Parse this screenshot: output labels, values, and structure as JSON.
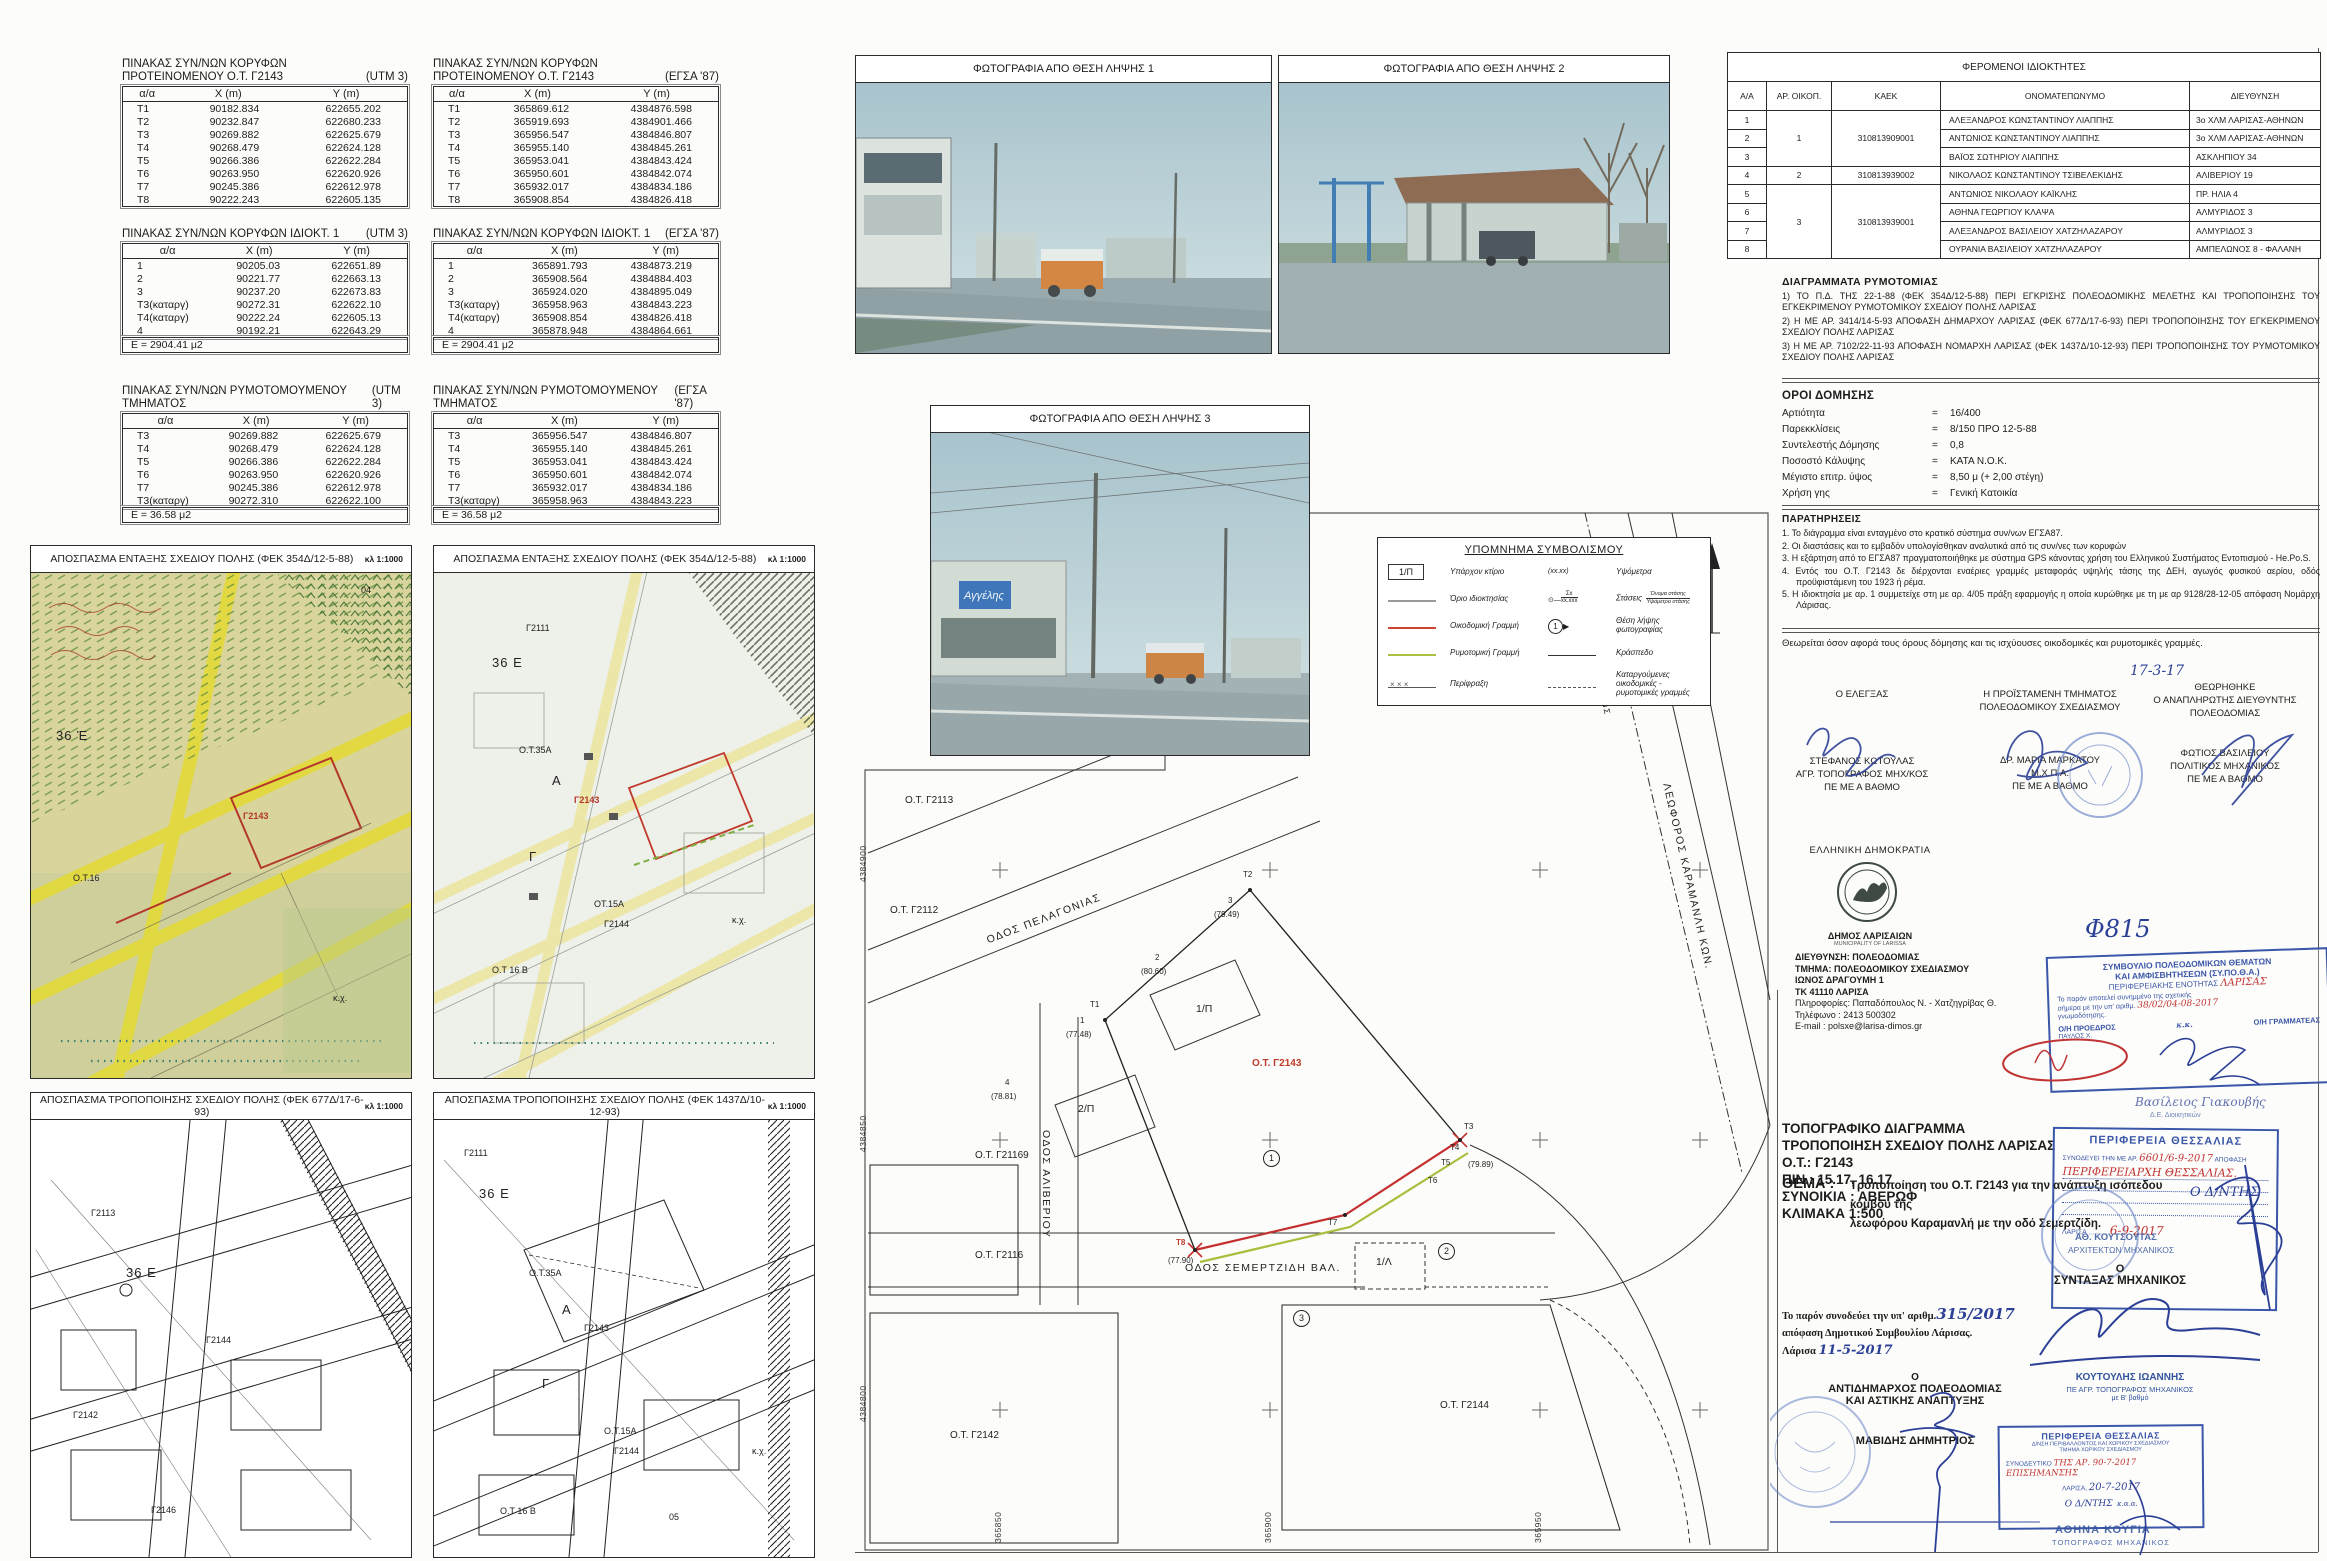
{
  "tables": {
    "cols": [
      "α/α",
      "X (m)",
      "Y (m)"
    ],
    "a": {
      "title1": "ΠΙΝΑΚΑΣ ΣΥΝ/ΝΩΝ ΚΟΡΥΦΩΝ",
      "title2": "ΠΡΟΤΕΙΝΟΜΕΝΟΥ Ο.Τ. Γ2143",
      "system": "(UTM 3)",
      "rows": [
        [
          "Τ1",
          "90182.834",
          "622655.202"
        ],
        [
          "Τ2",
          "90232.847",
          "622680.233"
        ],
        [
          "Τ3",
          "90269.882",
          "622625.679"
        ],
        [
          "Τ4",
          "90268.479",
          "622624.128"
        ],
        [
          "Τ5",
          "90266.386",
          "622622.284"
        ],
        [
          "Τ6",
          "90263.950",
          "622620.926"
        ],
        [
          "Τ7",
          "90245.386",
          "622612.978"
        ],
        [
          "Τ8",
          "90222.243",
          "622605.135"
        ]
      ]
    },
    "b": {
      "title1": "ΠΙΝΑΚΑΣ ΣΥΝ/ΝΩΝ ΚΟΡΥΦΩΝ",
      "title2": "ΠΡΟΤΕΙΝΟΜΕΝΟΥ Ο.Τ. Γ2143",
      "system": "(ΕΓΣΑ '87)",
      "rows": [
        [
          "Τ1",
          "365869.612",
          "4384876.598"
        ],
        [
          "Τ2",
          "365919.693",
          "4384901.466"
        ],
        [
          "Τ3",
          "365956.547",
          "4384846.807"
        ],
        [
          "Τ4",
          "365955.140",
          "4384845.261"
        ],
        [
          "Τ5",
          "365953.041",
          "4384843.424"
        ],
        [
          "Τ6",
          "365950.601",
          "4384842.074"
        ],
        [
          "Τ7",
          "365932.017",
          "4384834.186"
        ],
        [
          "Τ8",
          "365908.854",
          "4384826.418"
        ]
      ]
    },
    "c": {
      "title1": "ΠΙΝΑΚΑΣ ΣΥΝ/ΝΩΝ ΚΟΡΥΦΩΝ ΙΔΙΟΚΤ. 1",
      "title2": "",
      "system": "(UTM 3)",
      "footer": "Ε = 2904.41 μ2",
      "rows": [
        [
          "1",
          "90205.03",
          "622651.89"
        ],
        [
          "2",
          "90221.77",
          "622663.13"
        ],
        [
          "3",
          "90237.20",
          "622673.83"
        ],
        [
          "Τ3(καταργ)",
          "90272.31",
          "622622.10"
        ],
        [
          "Τ4(καταργ)",
          "90222.24",
          "622605.13"
        ],
        [
          "4",
          "90192.21",
          "622643.29"
        ]
      ]
    },
    "d": {
      "title1": "ΠΙΝΑΚΑΣ ΣΥΝ/ΝΩΝ ΚΟΡΥΦΩΝ ΙΔΙΟΚΤ. 1",
      "title2": "",
      "system": "(ΕΓΣΑ '87)",
      "footer": "Ε = 2904.41 μ2",
      "rows": [
        [
          "1",
          "365891.793",
          "4384873.219"
        ],
        [
          "2",
          "365908.564",
          "4384884.403"
        ],
        [
          "3",
          "365924.020",
          "4384895.049"
        ],
        [
          "Τ3(καταργ)",
          "365958.963",
          "4384843.223"
        ],
        [
          "Τ4(καταργ)",
          "365908.854",
          "4384826.418"
        ],
        [
          "4",
          "365878.948",
          "4384864.661"
        ]
      ]
    },
    "e": {
      "title1": "ΠΙΝΑΚΑΣ ΣΥΝ/ΝΩΝ ΡΥΜΟΤΟΜΟΥΜΕΝΟΥ ΤΜΗΜΑΤΟΣ",
      "title2": "",
      "system": "(UTM 3)",
      "footer": "Ε = 36.58 μ2",
      "rows": [
        [
          "Τ3",
          "90269.882",
          "622625.679"
        ],
        [
          "Τ4",
          "90268.479",
          "622624.128"
        ],
        [
          "Τ5",
          "90266.386",
          "622622.284"
        ],
        [
          "Τ6",
          "90263.950",
          "622620.926"
        ],
        [
          "Τ7",
          "90245.386",
          "622612.978"
        ],
        [
          "Τ3(καταργ)",
          "90272.310",
          "622622.100"
        ]
      ]
    },
    "f": {
      "title1": "ΠΙΝΑΚΑΣ ΣΥΝ/ΝΩΝ ΡΥΜΟΤΟΜΟΥΜΕΝΟΥ ΤΜΗΜΑΤΟΣ",
      "title2": "",
      "system": "(ΕΓΣΑ '87)",
      "footer": "Ε = 36.58 μ2",
      "rows": [
        [
          "Τ3",
          "365956.547",
          "4384846.807"
        ],
        [
          "Τ4",
          "365955.140",
          "4384845.261"
        ],
        [
          "Τ5",
          "365953.041",
          "4384843.424"
        ],
        [
          "Τ6",
          "365950.601",
          "4384842.074"
        ],
        [
          "Τ7",
          "365932.017",
          "4384834.186"
        ],
        [
          "Τ3(καταργ)",
          "365958.963",
          "4384843.223"
        ]
      ]
    }
  },
  "photos": [
    {
      "title": "ΦΩΤΟΓΡΑΦΙΑ ΑΠΟ ΘΕΣΗ ΛΗΨΗΣ 1"
    },
    {
      "title": "ΦΩΤΟΓΡΑΦΙΑ ΑΠΟ ΘΕΣΗ ΛΗΨΗΣ 2"
    },
    {
      "title": "ΦΩΤΟΓΡΑΦΙΑ ΑΠΟ ΘΕΣΗ ΛΗΨΗΣ 3",
      "sign": "Αγγέλης"
    }
  ],
  "excerpts": [
    {
      "title": "ΑΠΟΣΠΑΣΜΑ ΕΝΤΑΞΗΣ ΣΧΕΔΙΟΥ ΠΟΛΗΣ (ΦΕΚ 354Δ/12-5-88)",
      "scale": "κλ 1:1000",
      "labels": [
        {
          "t": "04",
          "x": 330,
          "y": 12
        },
        {
          "t": "36 Έ",
          "x": 25,
          "y": 155,
          "cls": "big"
        },
        {
          "t": "Γ2143",
          "x": 212,
          "y": 238,
          "cls": "red"
        },
        {
          "t": "Ο.Τ.16",
          "x": 42,
          "y": 300
        },
        {
          "t": "κ.χ.",
          "x": 302,
          "y": 420
        }
      ]
    },
    {
      "title": "ΑΠΟΣΠΑΣΜΑ ΕΝΤΑΞΗΣ ΣΧΕΔΙΟΥ ΠΟΛΗΣ (ΦΕΚ 354Δ/12-5-88)",
      "scale": "κλ 1:1000",
      "labels": [
        {
          "t": "Γ2111",
          "x": 92,
          "y": 50
        },
        {
          "t": "36 Ε",
          "x": 58,
          "y": 82,
          "cls": "big"
        },
        {
          "t": "Ο.Τ.35Α",
          "x": 85,
          "y": 172
        },
        {
          "t": "Α",
          "x": 118,
          "y": 200,
          "cls": "big"
        },
        {
          "t": "Γ2143",
          "x": 140,
          "y": 222,
          "cls": "red"
        },
        {
          "t": "Γ",
          "x": 95,
          "y": 276,
          "cls": "big"
        },
        {
          "t": "ΟΤ.15Α",
          "x": 160,
          "y": 326
        },
        {
          "t": "Γ2144",
          "x": 170,
          "y": 346
        },
        {
          "t": "Ο.Τ 16 Β",
          "x": 58,
          "y": 392
        },
        {
          "t": "κ.χ.",
          "x": 298,
          "y": 342
        }
      ]
    },
    {
      "title": "ΑΠΟΣΠΑΣΜΑ ΤΡΟΠΟΠΟΙΗΣΗΣ ΣΧΕΔΙΟΥ ΠΟΛΗΣ (ΦΕΚ 677Δ/17-6-93)",
      "scale": "κλ 1:1000",
      "labels": [
        {
          "t": "Γ2113",
          "x": 60,
          "y": 88
        },
        {
          "t": "36 Ε",
          "x": 95,
          "y": 145,
          "cls": "big"
        },
        {
          "t": "Γ2144",
          "x": 175,
          "y": 215
        },
        {
          "t": "Γ2142",
          "x": 42,
          "y": 290
        },
        {
          "t": "Γ2146",
          "x": 120,
          "y": 385
        }
      ]
    },
    {
      "title": "ΑΠΟΣΠΑΣΜΑ ΤΡΟΠΟΠΟΙΗΣΗΣ ΣΧΕΔΙΟΥ ΠΟΛΗΣ (ΦΕΚ 1437Δ/10-12-93)",
      "scale": "κλ 1:1000",
      "labels": [
        {
          "t": "Γ2111",
          "x": 30,
          "y": 28
        },
        {
          "t": "36 Ε",
          "x": 45,
          "y": 66,
          "cls": "big"
        },
        {
          "t": "Ο.Τ.35Α",
          "x": 95,
          "y": 148
        },
        {
          "t": "Α",
          "x": 128,
          "y": 182,
          "cls": "big"
        },
        {
          "t": "Γ2143",
          "x": 150,
          "y": 203
        },
        {
          "t": "Γ",
          "x": 108,
          "y": 256,
          "cls": "big"
        },
        {
          "t": "Ο.Τ.15Α",
          "x": 170,
          "y": 306
        },
        {
          "t": "Γ2144",
          "x": 180,
          "y": 326
        },
        {
          "t": "Ο.Τ 16 Β",
          "x": 66,
          "y": 386
        },
        {
          "t": "05",
          "x": 235,
          "y": 392
        },
        {
          "t": "κ.χ.",
          "x": 318,
          "y": 326
        }
      ]
    }
  ],
  "legend": {
    "title": "ΥΠΟΜΝΗΜΑ ΣΥΜΒΟΛΙΣΜΟΥ",
    "box_label": "1/Π",
    "left": [
      {
        "label": "Υπάρχον κτίριο"
      },
      {
        "label": "Όριο ιδιοκτησίας"
      },
      {
        "label": "Οικοδομική Γραμμή"
      },
      {
        "label": "Ρυμοτομική Γραμμή"
      },
      {
        "label": "Περίφραξη"
      }
    ],
    "right": [
      {
        "label": "Υψόμετρα",
        "sym": "(xx.xx)"
      },
      {
        "label": "Στάσεις",
        "sym_top": "Σx",
        "sym_bot": "xx.xxx",
        "name": "Όνομα στάσης",
        "elev": "Υψόμετρο στάσης"
      },
      {
        "label": "Θέση λήψης φωτογραφίας",
        "num": "1"
      },
      {
        "label": "Κράσπεδο"
      },
      {
        "label": "Καταργούμενες οικοδομικές - ρυμοτομικές γραμμές"
      }
    ]
  },
  "owners": {
    "title": "ΦΕΡΟΜΕΝΟΙ ΙΔΙΟΚΤΗΤΕΣ",
    "cols": [
      "Α/Α",
      "ΑΡ. ΟΙΚΟΠ.",
      "ΚΑΕΚ",
      "ΟΝΟΜΑΤΕΠΩΝΥΜΟ",
      "ΔΙΕΥΘΥΝΣΗ"
    ],
    "groups": [
      {
        "oikop": "1",
        "kaek": "310813909001"
      },
      {
        "oikop": "2",
        "kaek": "310813939002"
      },
      {
        "oikop": "3",
        "kaek": "310813939001"
      }
    ],
    "rows": [
      {
        "aa": "1",
        "name": "ΑΛΕΞΑΝΔΡΟΣ ΚΩΝΣΤΑΝΤΙΝΟΥ ΛΙΑΠΠΗΣ",
        "addr": "3ο ΧΛΜ ΛΑΡΙΣΑΣ-ΑΘΗΝΩΝ"
      },
      {
        "aa": "2",
        "name": "ΑΝΤΩΝΙΟΣ ΚΩΝΣΤΑΝΤΙΝΟΥ ΛΙΑΠΠΗΣ",
        "addr": "3ο ΧΛΜ ΛΑΡΙΣΑΣ-ΑΘΗΝΩΝ"
      },
      {
        "aa": "3",
        "name": "ΒΑΪΟΣ ΣΩΤΗΡΙΟΥ ΛΙΑΠΠΗΣ",
        "addr": "ΑΣΚΛΗΠΙΟΥ 34"
      },
      {
        "aa": "4",
        "name": "ΝΙΚΟΛΑΟΣ ΚΩΝΣΤΑΝΤΙΝΟΥ ΤΣΙΒΕΛΕΚΙΔΗΣ",
        "addr": "ΑΛΙΒΕΡΙΟΥ 19"
      },
      {
        "aa": "5",
        "name": "ΑΝΤΩΝΙΟΣ ΝΙΚΟΛΑΟΥ ΚΑΪΚΛΗΣ",
        "addr": "ΠΡ. ΗΛΙΑ 4"
      },
      {
        "aa": "6",
        "name": "ΑΘΗΝΑ ΓΕΩΡΓΙΟΥ ΚΛΑΨΑ",
        "addr": "ΑΛΜΥΡΙΔΟΣ 3"
      },
      {
        "aa": "7",
        "name": "ΑΛΕΞΑΝΔΡΟΣ ΒΑΣΙΛΕΙΟΥ ΧΑΤΖΗΛΑΖΑΡΟΥ",
        "addr": "ΑΛΜΥΡΙΔΟΣ 3"
      },
      {
        "aa": "8",
        "name": "ΟΥΡΑΝΙΑ ΒΑΣΙΛΕΙΟΥ ΧΑΤΖΗΛΑΖΑΡΟΥ",
        "addr": "ΑΜΠΕΛΩΝΟΣ 8 - ΦΑΛΑΝΗ"
      }
    ]
  },
  "diagrams": {
    "title": "ΔΙΑΓΡΑΜΜΑΤΑ ΡΥΜΟΤΟΜΙΑΣ",
    "items": [
      "1) ΤΟ Π.Δ. ΤΗΣ 22-1-88 (ΦΕΚ 354Δ/12-5-88) ΠΕΡΙ ΕΓΚΡΙΣΗΣ ΠΟΛΕΟΔΟΜΙΚΗΣ ΜΕΛΕΤΗΣ ΚΑΙ ΤΡΟΠΟΠΟΙΗΣΗΣ ΤΟΥ ΕΓΚΕΚΡΙΜΕΝΟΥ ΡΥΜΟΤΟΜΙΚΟΥ ΣΧΕΔΙΟΥ ΠΟΛΗΣ ΛΑΡΙΣΑΣ",
      "2) Η ΜΕ ΑΡ. 3414/14-5-93 ΑΠΟΦΑΣΗ ΔΗΜΑΡΧΟΥ ΛΑΡΙΣΑΣ (ΦΕΚ 677Δ/17-6-93) ΠΕΡΙ ΤΡΟΠΟΠΟΙΗΣΗΣ ΤΟΥ ΕΓΚΕΚΡΙΜΕΝΟΥ ΣΧΕΔΙΟΥ ΠΟΛΗΣ ΛΑΡΙΣΑΣ",
      "3) Η ΜΕ ΑΡ. 7102/22-11-93 ΑΠΟΦΑΣΗ ΝΟΜΑΡΧΗ ΛΑΡΙΣΑΣ (ΦΕΚ 1437Δ/10-12-93) ΠΕΡΙ ΤΡΟΠΟΠΟΙΗΣΗΣ ΤΟΥ ΡΥΜΟΤΟΜΙΚΟΥ ΣΧΕΔΙΟΥ ΠΟΛΗΣ  ΛΑΡΙΣΑΣ"
    ]
  },
  "terms": {
    "title": "ΟΡΟΙ ΔΟΜΗΣΗΣ",
    "eq": "=",
    "rows": [
      [
        "Αρτιότητα",
        "16/400"
      ],
      [
        "Παρεκκλίσεις",
        "8/150 ΠΡΟ 12-5-88"
      ],
      [
        "Συντελεστής Δόμησης",
        "0,8"
      ],
      [
        "Ποσοστό Κάλυψης",
        "ΚΑΤΑ Ν.Ο.Κ."
      ],
      [
        "Μέγιστο επιτρ. ύψος",
        "8,50 μ (+ 2,00 στέγη)"
      ],
      [
        "Χρήση γης",
        "Γενική Κατοικία"
      ]
    ]
  },
  "notes": {
    "title": "ΠΑΡΑΤΗΡΗΣΕΙΣ",
    "items": [
      "1.   Το διάγραμμα είναι ενταγμένο στο κρατικό σύστημα συν/νων ΕΓΣΑ87.",
      "2.   Οι διαστάσεις και το εμβαδόν υπολογίσθηκαν αναλυτικά από τις συν/νες των κορυφών",
      "3.   Η εξάρτηση από το ΕΓΣΑ87 πραγματοποιήθηκε με σύστημα GPS κάνοντας χρήση του Ελληνικού Συστήματος Εντοπισμού - He.Po.S.",
      "4.   Εντός του  Ο.Τ. Γ2143 δε διέρχονται εναέριες γραμμές μεταφοράς υψηλής τάσης της ΔΕΗ, αγωγός φυσικού αερίου, οδός προϋφιστάμενη του 1923 ή ρέμα.",
      "5.   Η ιδιοκτησία με αρ. 1 συμμετείχε στη με αρ. 4/05 πράξη εφαρμογής η οποία κυρώθηκε με τη με αρ 9128/28-12-05 απόφαση Νομάρχη Λάρισας."
    ]
  },
  "approval": "Θεωρείται όσον αφορά τους όρους δόμησης και τις ισχύουσες οικοδομικές και ρυμοτομικές γραμμές.",
  "signs": {
    "date": "17-3-17",
    "c1": {
      "role": "Ο ΕΛΕΓΞΑΣ",
      "name": "ΣΤΕΦΑΝΟΣ ΚΩΤΟΥΛΑΣ",
      "title": "ΑΓΡ. ΤΟΠΟΓΡΑΦΟΣ ΜΗΧ/ΚΟΣ",
      "grade": "ΠΕ ΜΕ Α ΒΑΘΜΟ"
    },
    "c2": {
      "role1": "Η ΠΡΟΪΣΤΑΜΕΝΗ ΤΜΗΜΑΤΟΣ",
      "role2": "ΠΟΛΕΟΔΟΜΙΚΟΥ ΣΧΕΔΙΑΣΜΟΥ",
      "name": "ΔΡ. ΜΑΡΙΑ ΜΑΡΚΑΤΟΥ",
      "title": "Μ.Χ.Π.Α.",
      "grade": "ΠΕ ΜΕ Α ΒΑΘΜΟ"
    },
    "c3": {
      "head": "ΘΕΩΡΗΘΗΚΕ",
      "role1": "Ο ΑΝΑΠΛΗΡΩΤΗΣ ΔΙΕΥΘΥΝΤΗΣ",
      "role2": "ΠΟΛΕΟΔΟΜΙΑΣ",
      "name": "ΦΩΤΙΟΣ ΒΑΣΙΛΕΙΟΥ",
      "title": "ΠΟΛΙΤΙΚΟΣ ΜΗΧΑΝΙΚΟΣ",
      "grade": "ΠΕ ΜΕ Α ΒΑΘΜΟ"
    }
  },
  "agency": {
    "state": "ΕΛΛΗΝΙΚΗ ΔΗΜΟΚΡΑΤΙΑ",
    "muni": "ΔΗΜΟΣ ΛΑΡΙΣΑΙΩΝ",
    "muni_en": "MUNICIPALITY OF LARISSA",
    "dir": "ΔΙΕΥΘΥΝΣΗ: ΠΟΛΕΟΔΟΜΙΑΣ",
    "dept": "ΤΜΗΜΑ: ΠΟΛΕΟΔΟΜΙΚΟΥ ΣΧΕΔΙΑΣΜΟΥ",
    "addr1": "ΙΩΝΟΣ ΔΡΑΓΟΥΜΗ 1",
    "addr2": "ΤΚ 41110  ΛΑΡΙΣΑ",
    "info": "Πληροφορίες: Παπαδόπουλος Ν. - Χατζηγρίβας Θ.",
    "tel": "Τηλέφωνο :    2413 500302",
    "email": "E-mail        :  polsxe@larisa-dimos.gr"
  },
  "sypotha": {
    "l1": "ΣΥΜΒΟΥΛΙΟ ΠΟΛΕΟΔΟΜΙΚΩΝ ΘΕΜΑΤΩΝ",
    "l2": "ΚΑΙ ΑΜΦΙΣΒΗΤΗΣΕΩΝ (ΣΥ.ΠΟ.Θ.Α.)",
    "l3": "ΠΕΡΙΦΕΡΕΙΑΚΗΣ ΕΝΟΤΗΤΑΣ",
    "l3b": "ΛΑΡΙΣΑΣ",
    "l4": "Το παρόν αποτελεί συνημμένο της σχετικής",
    "l5": "σήμερα με την υπ' αριθμ.",
    "num": "38/02/04-08-2017",
    "l6": "γνωμοδότησης.",
    "pres": "Ο/Η ΠΡΟΕΔΡΟΣ",
    "secr": "Ο/Η ΓΡΑΜΜΑΤΕΑΣ",
    "sig1": "ΠΑΥΛΟΣ Χ.",
    "kk": "κ.κ.",
    "below": "Βασίλειος Γιακουβής",
    "below2": "Δ.Ε. Διοικητικών"
  },
  "file_no": "Φ815",
  "title_block": {
    "l1": "ΤΟΠΟΓΡΑΦΙΚΟ  ΔΙΑΓΡΑΜΜΑ",
    "l2": "ΤΡΟΠΟΠΟΙΗΣΗ  ΣΧΕΔΙΟΥ  ΠΟΛΗΣ  ΛΑΡΙΣΑΣ",
    "l3": "Ο.Τ.:  Γ2143",
    "l4": "ΠΙΝ.:  15.17, 16.17",
    "l5": "ΣΥΝΟΙΚΙΑ : ΑΒΕΡΩΦ",
    "l6": "ΚΛΙΜΑΚΑ 1:500"
  },
  "region1": {
    "title": "ΠΕΡΙΦΕΡΕΙΑ  ΘΕΣΣΑΛΙΑΣ",
    "pre": "ΣΥΝΟΔΕΥΕΙ ΤΗΝ ΜΕ ΑΡ.",
    "num": "6601/6-9-2017",
    "post": "ΑΠΟΦΑΣΗ",
    "hand": "ΠΕΡΙΦΕΡΕΙΑΡΧΗ  ΘΕΣΣΑΛΙΑΣ.",
    "city": "ΛΑΡΙΣΑ",
    "date": "6-9-2017"
  },
  "thema": {
    "label": "ΘΕΜΑ :",
    "line1": "Τροποποίηση  του  Ο.Τ.  Γ2143  για  την  ανάπτυξη  ισόπεδου  κόμβου  της",
    "line2": "λεωφόρου Καραμανλή με την οδό Σεμερτζίδη."
  },
  "accompany": {
    "l1": "Το  παρόν  συνοδεύει  την υπ' αριθμ.",
    "num": "315/2017",
    "l2": "απόφαση Δημοτικού Συμβουλίου Λάρισας.",
    "l3": "Λάρισα",
    "date": "11-5-2017"
  },
  "engineer": {
    "o": "Ο",
    "role": "ΣΥΝΤΑΞΑΣ  ΜΗΧΑΝΙΚΟΣ",
    "name": "ΚΟΥΤΟΥΛΗΣ ΙΩΑΝΝΗΣ",
    "t1": "ΠΕ ΑΓΡ. ΤΟΠΟΓΡΑΦΟΣ ΜΗΧΑΝΙΚΟΣ",
    "t2": "με Β' βαθμό"
  },
  "director": {
    "hand": "Ο Δ/ΝΤΗΣ",
    "name": "ΑΘ. ΚΟΥΤΣΟΥΤΑΣ",
    "t1": "ΑΡΧΙΤΕΚΤΩΝ ΜΗΧΑΝΙΚΟΣ"
  },
  "deputy": {
    "o": "Ο",
    "r1": "ΑΝΤΙΔΗΜΑΡΧΟΣ ΠΟΛΕΟΔΟΜΙΑΣ",
    "r2": "ΚΑΙ ΑΣΤΙΚΗΣ ΑΝΑΠΤΥΞΗΣ",
    "name": "ΜΑΒΙΔΗΣ ΔΗΜΗΤΡΙΟΣ"
  },
  "region2": {
    "title": "ΠΕΡΙΦΕΡΕΙΑ  ΘΕΣΣΑΛΙΑΣ",
    "l2": "Δ/ΝΣΗ ΠΕΡΙΒΑΛΛΟΝΤΟΣ ΚΑΙ ΧΩΡΙΚΟΥ ΣΧΕΔΙΑΣΜΟΥ",
    "l3": "ΤΜΗΜΑ ΧΩΡΙΚΟΥ ΣΧΕΔΙΑΣΜΟΥ",
    "pre": "ΣΥΝΟΔΕΥΤΙΚΟ",
    "hand": "ΤΗΣ ΑΡ. 90-7-2017 ΕΠΙΣΗΜΑΝΣΗΣ",
    "city": "ΛΑΡΙΣΑ,",
    "date": "20-7-2017",
    "dnt": "Ο Δ/ΝΤΗΣ",
    "kaa": "κ.α.α."
  },
  "kougias": {
    "name": "ΑΘΗΝΑ  ΚΟΥΓΙΑ",
    "t1": "ΤΟΠΟΓΡΑΦΟΣ  ΜΗΧΑΝΙΚΟΣ"
  },
  "plan": {
    "labels": [
      {
        "t": "Ο.Τ. Γ2113",
        "x": 905,
        "y": 795
      },
      {
        "t": "Ο.Τ. Γ2112",
        "x": 890,
        "y": 905
      },
      {
        "t": "ΟΔΟΣ ΠΕΛΑΓΟΝΙΑΣ",
        "x": 985,
        "y": 935,
        "rot": -21,
        "cls": "street"
      },
      {
        "t": "Ο.Τ. Γ21169",
        "x": 975,
        "y": 1150
      },
      {
        "t": "ΟΔΟΣ ΑΛΙΒΕΡΙΟΥ",
        "x": 1052,
        "y": 1130,
        "rot": 90,
        "cls": "street"
      },
      {
        "t": "Ο.Τ. Γ2116",
        "x": 975,
        "y": 1250
      },
      {
        "t": "Ο.Τ. Γ2142",
        "x": 950,
        "y": 1430
      },
      {
        "t": "Ο.Τ. Γ2144",
        "x": 1440,
        "y": 1400
      },
      {
        "t": "Ο.Τ. Γ2143",
        "x": 1252,
        "y": 1058,
        "cls": "red"
      },
      {
        "t": "ΟΔΟΣ ΣΕΜΕΡΤΖΙΔΗ ΒΑΛ.",
        "x": 1185,
        "y": 1262,
        "cls": "street"
      },
      {
        "t": "ΛΕΩΦΟΡΟΣ ΚΑΡΑΜΑΝΛΗ ΚΩΝ.",
        "x": 1672,
        "y": 782,
        "rot": 77,
        "cls": "street"
      },
      {
        "t": "ΟΡΙΟ ΣΧΕΔΙΟΥ ΠΟΛΗΣ",
        "x": 1586,
        "y": 598,
        "rot": 77,
        "cls": "street small"
      },
      {
        "t": "Τ1",
        "x": 1090,
        "y": 1000,
        "cls": "pt"
      },
      {
        "t": "Τ2",
        "x": 1243,
        "y": 870,
        "cls": "pt"
      },
      {
        "t": "Τ3",
        "x": 1464,
        "y": 1122,
        "cls": "pt"
      },
      {
        "t": "Τ4",
        "x": 1450,
        "y": 1143,
        "cls": "pt"
      },
      {
        "t": "Τ5",
        "x": 1441,
        "y": 1158,
        "cls": "pt"
      },
      {
        "t": "(79.89)",
        "x": 1468,
        "y": 1160,
        "cls": "pt"
      },
      {
        "t": "Τ6",
        "x": 1428,
        "y": 1176,
        "cls": "pt"
      },
      {
        "t": "Τ7",
        "x": 1328,
        "y": 1218,
        "cls": "pt"
      },
      {
        "t": "Τ8",
        "x": 1176,
        "y": 1238,
        "cls": "pt red"
      },
      {
        "t": "(77.90)",
        "x": 1168,
        "y": 1256,
        "cls": "pt"
      },
      {
        "t": "3",
        "x": 1228,
        "y": 896,
        "cls": "pt"
      },
      {
        "t": "(79.49)",
        "x": 1214,
        "y": 910,
        "cls": "pt"
      },
      {
        "t": "2",
        "x": 1155,
        "y": 953,
        "cls": "pt"
      },
      {
        "t": "(80.60)",
        "x": 1141,
        "y": 967,
        "cls": "pt"
      },
      {
        "t": "1",
        "x": 1080,
        "y": 1016,
        "cls": "pt"
      },
      {
        "t": "(77.48)",
        "x": 1066,
        "y": 1030,
        "cls": "pt"
      },
      {
        "t": "4",
        "x": 1005,
        "y": 1078,
        "cls": "pt"
      },
      {
        "t": "(78.81)",
        "x": 991,
        "y": 1092,
        "cls": "pt"
      },
      {
        "t": "1/Π",
        "x": 1196,
        "y": 1003,
        "cls": "bld"
      },
      {
        "t": "2/Π",
        "x": 1078,
        "y": 1103,
        "cls": "bld"
      },
      {
        "t": "1/Λ",
        "x": 1376,
        "y": 1256,
        "cls": "bld"
      },
      {
        "t": "1",
        "x": 1263,
        "y": 1150,
        "cls": "circ"
      },
      {
        "t": "2",
        "x": 1438,
        "y": 1243,
        "cls": "circ"
      },
      {
        "t": "3",
        "x": 1293,
        "y": 1310,
        "cls": "circ"
      },
      {
        "t": "4384900",
        "x": 858,
        "y": 882,
        "rot": -90,
        "cls": "coord"
      },
      {
        "t": "4384850",
        "x": 858,
        "y": 1152,
        "rot": -90,
        "cls": "coord"
      },
      {
        "t": "4384800",
        "x": 858,
        "y": 1422,
        "rot": -90,
        "cls": "coord"
      },
      {
        "t": "365850",
        "x": 993,
        "y": 1543,
        "rot": -90,
        "cls": "coord"
      },
      {
        "t": "365900",
        "x": 1263,
        "y": 1543,
        "rot": -90,
        "cls": "coord"
      },
      {
        "t": "365950",
        "x": 1533,
        "y": 1543,
        "rot": -90,
        "cls": "coord"
      }
    ]
  }
}
